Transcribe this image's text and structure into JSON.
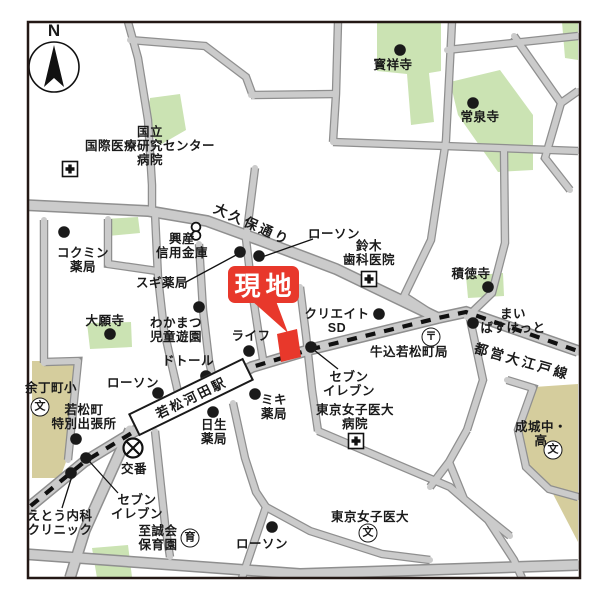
{
  "compass": {
    "north": "N"
  },
  "site": {
    "label": "現地"
  },
  "station": {
    "name": "若松河田駅"
  },
  "roads": {
    "okubo": "大久保通り",
    "oedo": "都営大江戸線"
  },
  "symbols": {
    "school": "文",
    "nursery": "育",
    "post": "〒"
  },
  "pois": [
    {
      "id": "nccgm-hospital",
      "text": "国立\n国際医療研究センター\n病院"
    },
    {
      "id": "hoshoji-temple",
      "text": "寳祥寺"
    },
    {
      "id": "josenji-temple",
      "text": "常泉寺"
    },
    {
      "id": "kokumin-pharmacy",
      "text": "コクミン\n薬局"
    },
    {
      "id": "kosan-shinkin-bank",
      "text": "興産\n信用金庫"
    },
    {
      "id": "sugi-pharmacy",
      "text": "スギ薬局"
    },
    {
      "id": "lawson-north",
      "text": "ローソン"
    },
    {
      "id": "suzuki-dental",
      "text": "鈴木\n歯科医院"
    },
    {
      "id": "sekitokuji-temple",
      "text": "積徳寺"
    },
    {
      "id": "my-basket",
      "text": "まい\nばすけっと"
    },
    {
      "id": "create-sd",
      "text": "クリエイト\nSD"
    },
    {
      "id": "ushigome-wakamatsucho-post-office",
      "text": "牛込若松町局"
    },
    {
      "id": "daiganji-temple",
      "text": "大願寺"
    },
    {
      "id": "wakamatsu-childrens-park",
      "text": "わかまつ\n児童遊園"
    },
    {
      "id": "life-supermarket",
      "text": "ライフ"
    },
    {
      "id": "doutor",
      "text": "ドトール"
    },
    {
      "id": "lawson-mid",
      "text": "ローソン"
    },
    {
      "id": "miki-pharmacy",
      "text": "ミキ\n薬局"
    },
    {
      "id": "nissei-pharmacy",
      "text": "日生\n薬局"
    },
    {
      "id": "yochomachi-elementary",
      "text": "余丁町小"
    },
    {
      "id": "wakamatsucho-branch-office",
      "text": "若松町\n特別出張所"
    },
    {
      "id": "koban-police-box",
      "text": "交番"
    },
    {
      "id": "seven-eleven-west",
      "text": "セブン\nイレブン"
    },
    {
      "id": "eto-clinic",
      "text": "えとう内科\nクリニック"
    },
    {
      "id": "shiseikai-nursery",
      "text": "至誠会\n保育園"
    },
    {
      "id": "seven-eleven-east",
      "text": "セブン\nイレブン"
    },
    {
      "id": "tokyo-womens-medical-univ-hospital",
      "text": "東京女子医大\n病院"
    },
    {
      "id": "tokyo-womens-medical-univ",
      "text": "東京女子医大"
    },
    {
      "id": "lawson-south",
      "text": "ローソン"
    },
    {
      "id": "seijo-jr-sr-high",
      "text": "成城中・高"
    }
  ],
  "colors": {
    "site_red": "#e8382b",
    "park_green": "#cbe3b3",
    "school_khaki": "#d5cd9d",
    "road_fill": "#cbcbcb",
    "road_edge": "#8f8f8f",
    "railway_black": "#111111"
  }
}
